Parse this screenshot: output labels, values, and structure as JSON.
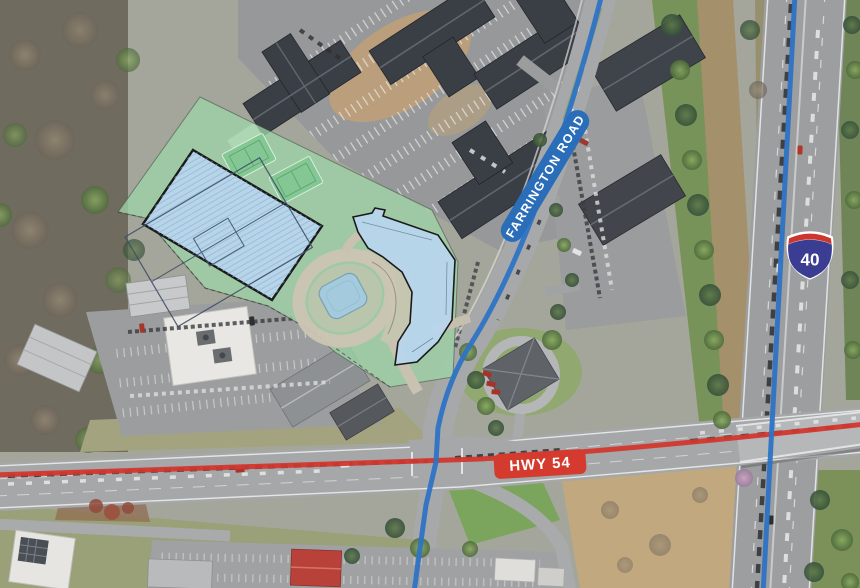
{
  "map": {
    "road_labels": [
      {
        "id": "farrington-road",
        "text": "FARRINGTON ROAD",
        "bg_color": "#2a6db8",
        "text_color": "#ffffff"
      },
      {
        "id": "hwy-54",
        "text": "HWY 54",
        "bg_color": "#d43b2e",
        "text_color": "#ffffff"
      }
    ],
    "interstate_shield": {
      "number": "40",
      "body_color": "#3a3d92",
      "crest_color": "#ce352c",
      "outline_color": "#ffffff",
      "text_color": "#ffffff"
    },
    "route_highlights": {
      "farrington_road_color": "#2e73c5",
      "interstate_40_color": "#2e73c5",
      "hwy_54_color": "#d2372d"
    },
    "site_plan_overlay": {
      "site_area_color": "#9ed3a6",
      "parking_field_color": "#b9d6ef",
      "proposed_building_color": "#b9d6ef",
      "outline_color": "#1a1a1a",
      "pond_color": "#a3cbdd",
      "courts_color": "#84c794"
    }
  }
}
